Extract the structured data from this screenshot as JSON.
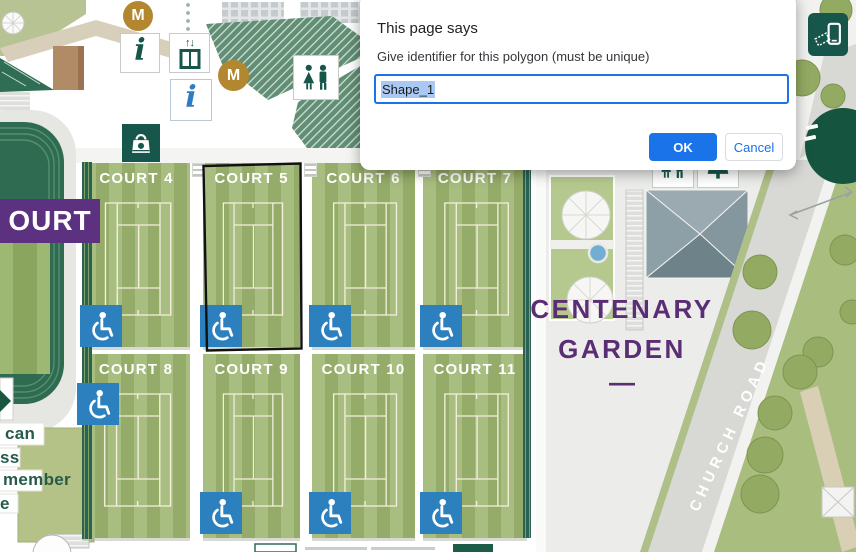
{
  "dialog": {
    "title": "This page says",
    "message": "Give identifier for this polygon (must be unique)",
    "input_value": "Shape_1",
    "buttons": {
      "ok": "OK",
      "cancel": "Cancel"
    }
  },
  "map": {
    "courts": [
      {
        "label": "COURT 4"
      },
      {
        "label": "COURT 5"
      },
      {
        "label": "COURT 6"
      },
      {
        "label": "COURT 7"
      },
      {
        "label": "COURT 8"
      },
      {
        "label": "COURT 9"
      },
      {
        "label": "COURT 10"
      },
      {
        "label": "COURT 11"
      }
    ],
    "selected_polygon_court": "COURT 5",
    "banner_partial": "OURT",
    "garden": {
      "line1": "CENTENARY",
      "line2": "GARDEN",
      "dash": "—"
    },
    "road": "CHURCH ROAD",
    "left_text_fragments": {
      "l1": "can",
      "l2": "ss",
      "l3": "member",
      "l4": "e"
    },
    "markers": {
      "m": "M",
      "info": "i"
    },
    "colors": {
      "court_light": "#a8bd80",
      "court_dark": "#95ab69",
      "wimbledon_purple": "#5b2d74",
      "dark_green": "#17564a",
      "accessible_blue": "#2b80bd",
      "gold": "#b3872f",
      "dialog_accent": "#1a73e8"
    }
  }
}
